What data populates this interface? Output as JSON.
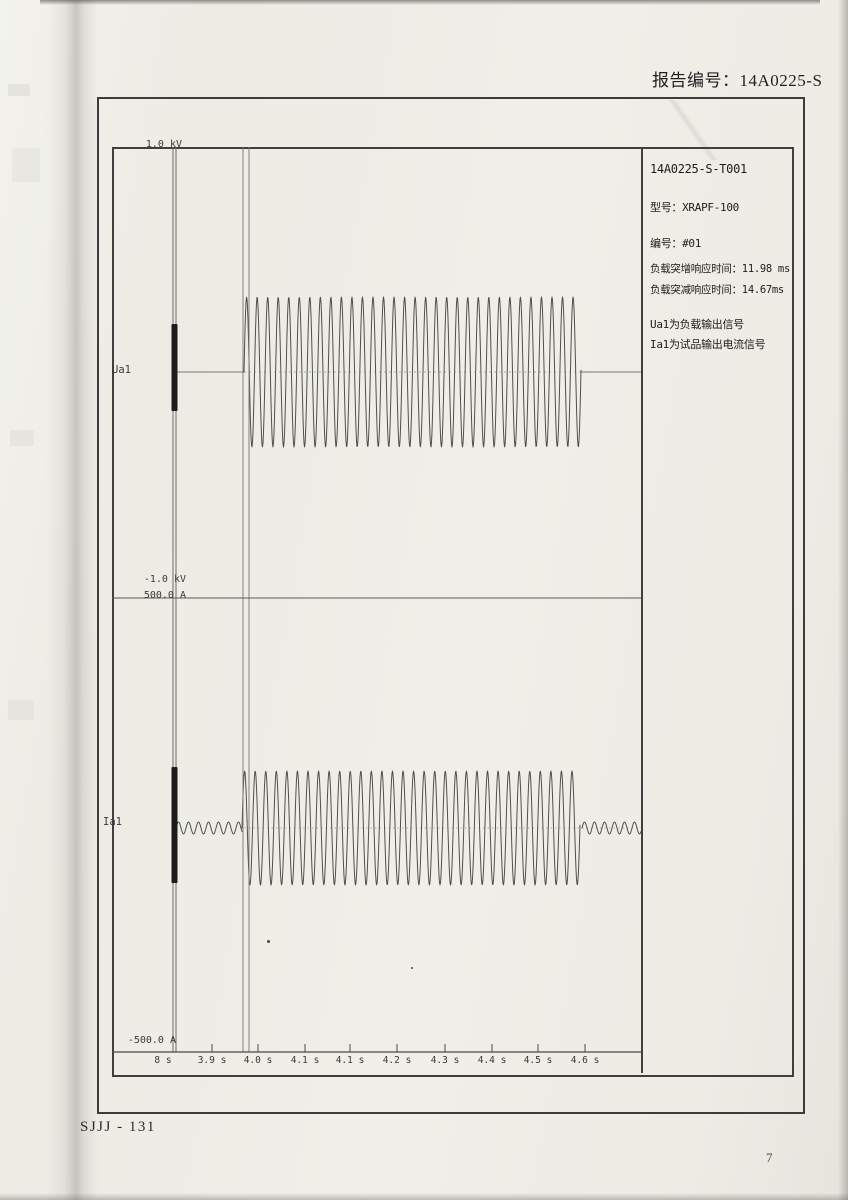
{
  "colors": {
    "ink": "#3f3f3f",
    "wave": "#4f4f4f",
    "baseline": "#777777",
    "paper": "#eeece5",
    "thick_mark": "#1c1c1c"
  },
  "header": {
    "report_label": "报告编号：14A0225-S"
  },
  "footer": {
    "doc_code": "SJJJ - 131",
    "page_number": "7"
  },
  "info_panel": {
    "test_id": "14A0225-S-T001",
    "model": "型号：XRAPF-100",
    "unit_no": "编号：#01",
    "rise_response": "负载突增响应时间：11.98 ms",
    "fall_response": "负载突减响应时间：14.67ms",
    "note_ua1": "Ua1为负载输出信号",
    "note_ia1": "Ia1为试品输出电流信号"
  },
  "chart_data": {
    "type": "line",
    "title": "",
    "xlabel": "",
    "ylabel": "",
    "legend": "none",
    "grid": false,
    "x_tick_labels": [
      "8 s",
      "3.9 s",
      "4.0 s",
      "4.1 s",
      "4.1 s",
      "4.2 s",
      "4.3 s",
      "4.4 s",
      "4.5 s",
      "4.6 s"
    ],
    "x_range_s": [
      3.8,
      4.6
    ],
    "channels": [
      {
        "name": "Ua1",
        "unit": "kV",
        "scale_max_label": "1.0 kV",
        "scale_min_label": "-1.0 kV",
        "ylim": [
          -1.0,
          1.0
        ],
        "idle_value": 0,
        "burst_amplitude": 0.33,
        "burst_start_s": 3.97,
        "burst_end_s": 4.69,
        "burst_cycles": 32
      },
      {
        "name": "Ia1",
        "unit": "A",
        "scale_max_label": "500.0 A",
        "scale_min_label": "-500.0 A",
        "ylim": [
          -500.0,
          500.0
        ],
        "idle_ripple_amplitude": 13,
        "burst_amplitude": 128,
        "burst_start_s": 3.97,
        "burst_end_s": 4.68,
        "burst_cycles": 32
      }
    ],
    "render": {
      "svg_w": 529,
      "svg_h": 922,
      "tick_x": [
        51,
        100,
        146,
        193,
        238,
        285,
        333,
        380,
        426,
        473
      ],
      "left_axis_x": [
        61,
        64
      ],
      "cursor_x": [
        131,
        137
      ],
      "mid_y": 451,
      "axis_y": 905,
      "tick_len": 8,
      "thick_marks": [
        {
          "x": 59.5,
          "w": 6,
          "y1": 177,
          "y2": 264
        },
        {
          "x": 59.5,
          "w": 6,
          "y1": 620,
          "y2": 736
        }
      ],
      "top_wave": {
        "cy": 225,
        "amp": 75,
        "x0": 132,
        "x1": 469,
        "period": 10.53
      },
      "bottom_wave": {
        "cy": 681,
        "amp": 57,
        "x0": 130,
        "x1": 468,
        "period": 10.56
      },
      "pre_ripple": {
        "cy": 681,
        "amp": 6,
        "x0": 64,
        "x1": 130,
        "period": 10
      },
      "post_ripple": {
        "cy": 681,
        "amp": 6,
        "x0": 470,
        "x1": 529,
        "period": 10
      }
    }
  }
}
